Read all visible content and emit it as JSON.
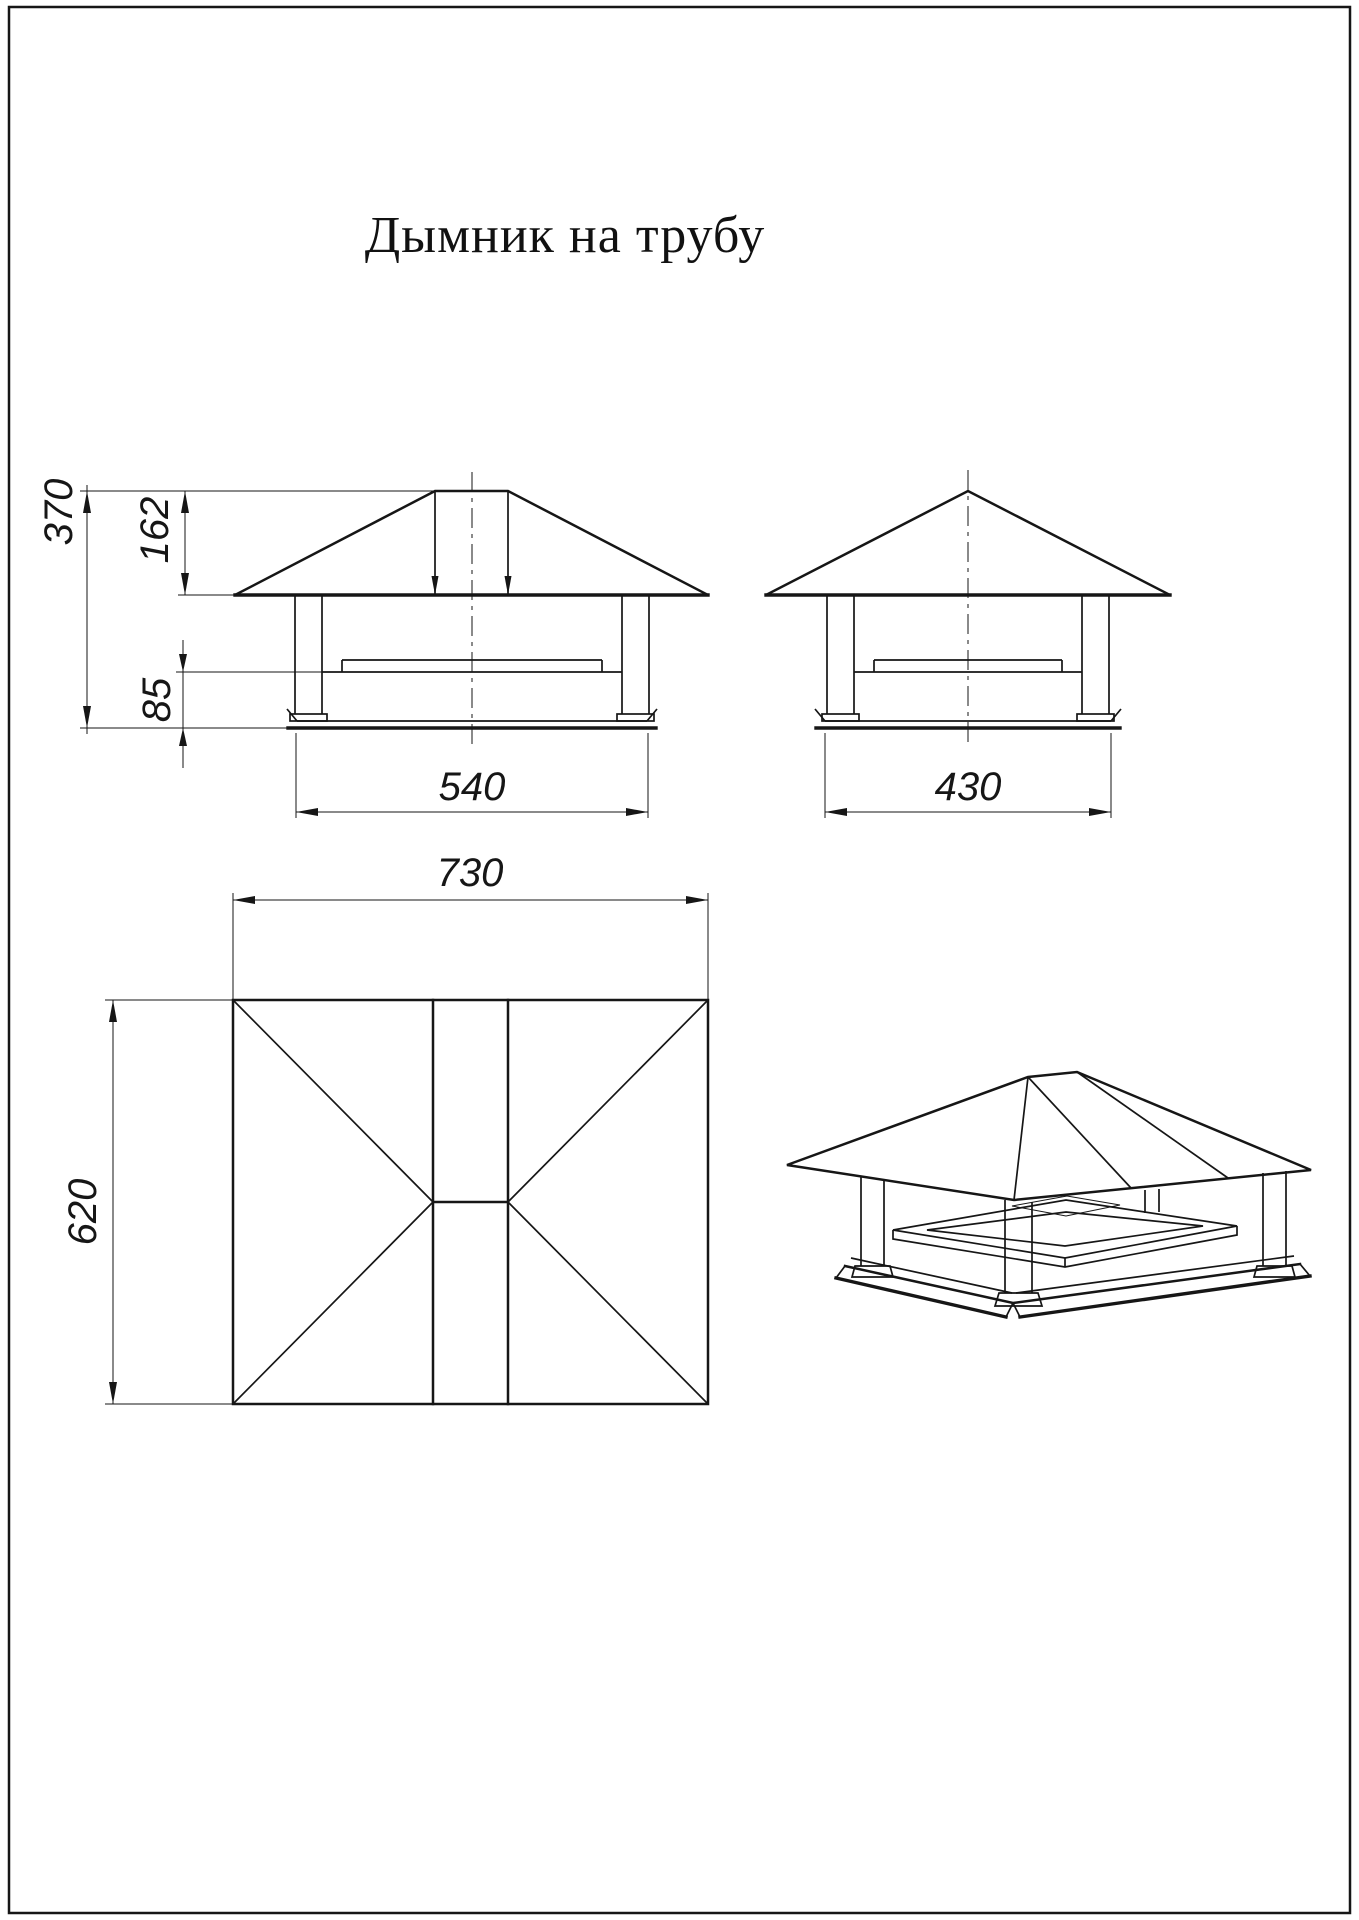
{
  "page": {
    "title": "Дымник на трубу"
  },
  "drawing": {
    "front_view": {
      "dim_overall_height": "370",
      "dim_roof_height": "162",
      "dim_skirt_height": "85",
      "dim_base_width": "540"
    },
    "side_view": {
      "dim_base_width": "430"
    },
    "plan_view": {
      "dim_width": "730",
      "dim_depth": "620"
    }
  }
}
